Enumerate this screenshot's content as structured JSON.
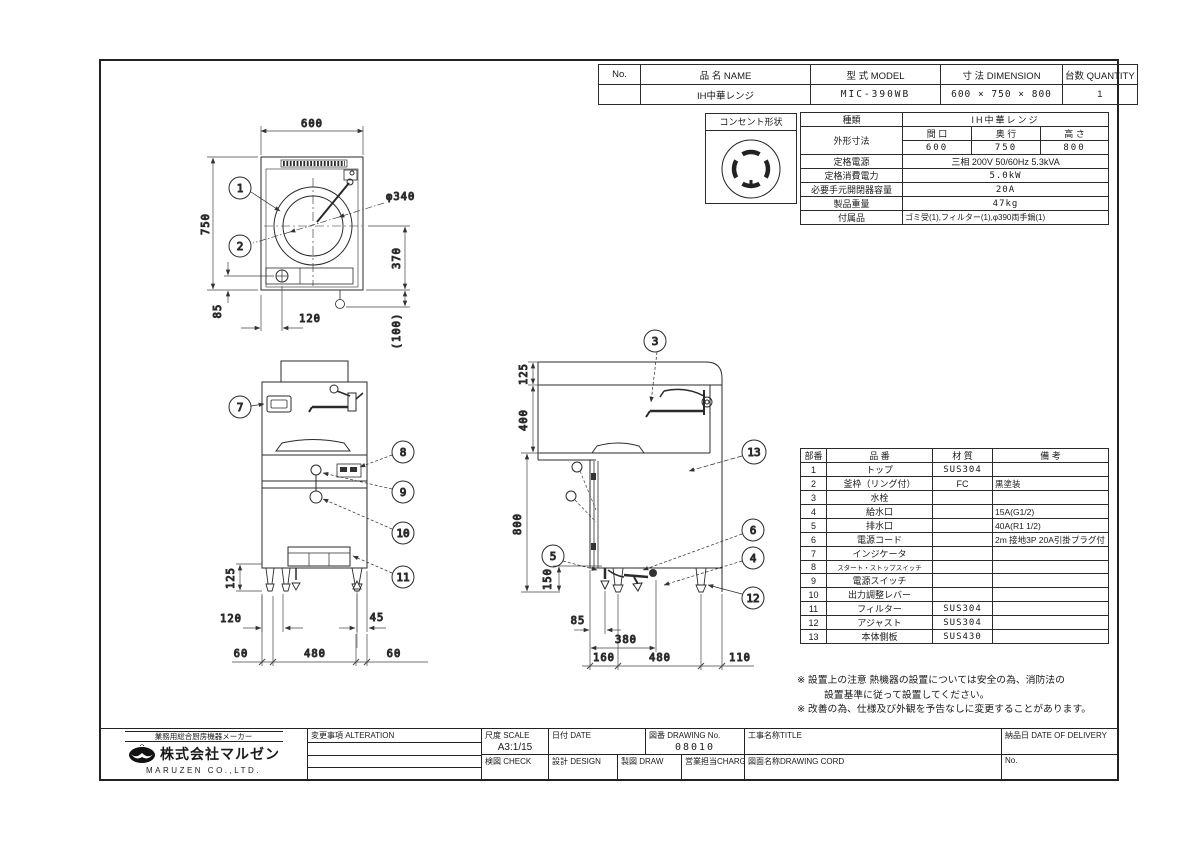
{
  "header_table": {
    "col_no": "No.",
    "col_name": "品 名  NAME",
    "col_model": "型 式  MODEL",
    "col_dimension": "寸 法  DIMENSION",
    "col_quantity": "台数 QUANTITY",
    "row": {
      "no": "",
      "name": "IH中華レンジ",
      "model": "MIC-390WB",
      "dimension": "600 × 750 × 800",
      "quantity": "1"
    }
  },
  "outlet": {
    "label": "コンセント形状"
  },
  "spec": {
    "kind_label": "種類",
    "kind_value": "IH中華レンジ",
    "dims_label": "外形寸法",
    "width_label": "間 口",
    "depth_label": "奥 行",
    "height_label": "高 さ",
    "width_value": "600",
    "depth_value": "750",
    "height_value": "800",
    "power_label": "定格電源",
    "power_value": "三相 200V 50/60Hz 5.3kVA",
    "consumption_label": "定格消費電力",
    "consumption_value": "5.0kW",
    "breaker_label": "必要手元開閉器容量",
    "breaker_value": "20A",
    "weight_label": "製品重量",
    "weight_value": "47kg",
    "accessories_label": "付属品",
    "accessories_value": "ゴミ受(1),フィルター(1),φ390両手鍋(1)"
  },
  "parts": {
    "h_no": "部番",
    "h_name": "品 番",
    "h_material": "材 質",
    "h_note": "備  考",
    "rows": [
      {
        "no": "1",
        "name": "トップ",
        "material": "SUS304",
        "note": ""
      },
      {
        "no": "2",
        "name": "釜枠（リング付）",
        "material": "FC",
        "note": "黒塗装"
      },
      {
        "no": "3",
        "name": "水栓",
        "material": "",
        "note": ""
      },
      {
        "no": "4",
        "name": "給水口",
        "material": "",
        "note": "15A(G1/2)"
      },
      {
        "no": "5",
        "name": "排水口",
        "material": "",
        "note": "40A(R1 1/2)"
      },
      {
        "no": "6",
        "name": "電源コード",
        "material": "",
        "note": "2m 接地3P 20A引掛プラグ付"
      },
      {
        "no": "7",
        "name": "インジケータ",
        "material": "",
        "note": ""
      },
      {
        "no": "8",
        "name": "スタート・ストップスイッチ",
        "material": "",
        "note": ""
      },
      {
        "no": "9",
        "name": "電源スイッチ",
        "material": "",
        "note": ""
      },
      {
        "no": "10",
        "name": "出力調整レバー",
        "material": "",
        "note": ""
      },
      {
        "no": "11",
        "name": "フィルター",
        "material": "SUS304",
        "note": ""
      },
      {
        "no": "12",
        "name": "アジャスト",
        "material": "SUS304",
        "note": ""
      },
      {
        "no": "13",
        "name": "本体側板",
        "material": "SUS430",
        "note": ""
      }
    ]
  },
  "notes": {
    "note1a": "※ 設置上の注意 熱機器の設置については安全の為、消防法の",
    "note1b": "設置基準に従って設置してください。",
    "note2": "※ 改善の為、仕様及び外観を予告なしに変更することがあります。"
  },
  "titleblock": {
    "maker_tagline": "業務用総合厨房機器メーカー",
    "company": "株式会社マルゼン",
    "company_en": "MARUZEN CO.,LTD.",
    "alteration_label": "変更事項  ALTERATION",
    "scale_label": "尺度 SCALE",
    "scale_value": "A3:1/15",
    "date_label": "日付 DATE",
    "drawing_no_label": "図番 DRAWING No.",
    "drawing_no_value": "08010",
    "title_label": "工事名称TITLE",
    "delivery_label": "納品日  DATE OF DELIVERY",
    "check_label": "検図 CHECK",
    "design_label": "設計 DESIGN",
    "draw_label": "製図 DRAW",
    "charge_label": "営業担当CHARGE",
    "drawing_name_label": "図面名称DRAWING CORD",
    "delivery_no_label": "No."
  },
  "plan": {
    "dim_width": "600",
    "dim_depth": "750",
    "dim_circle": "φ340",
    "dim_370": "370",
    "dim_100": "(100)",
    "dim_85": "85",
    "dim_120": "120",
    "b1": "1",
    "b2": "2"
  },
  "front": {
    "dim_125": "125",
    "dim_120": "120",
    "dim_45": "45",
    "dim_60a": "60",
    "dim_480": "480",
    "dim_60b": "60",
    "b7": "7",
    "b8": "8",
    "b9": "9",
    "b10": "10",
    "b11": "11"
  },
  "side": {
    "dim_125": "125",
    "dim_400": "400",
    "dim_800": "800",
    "dim_150": "150",
    "dim_85": "85",
    "dim_380": "380",
    "dim_160": "160",
    "dim_480": "480",
    "dim_110": "110",
    "b3": "3",
    "b4": "4",
    "b5": "5",
    "b6": "6",
    "b12": "12",
    "b13": "13"
  }
}
